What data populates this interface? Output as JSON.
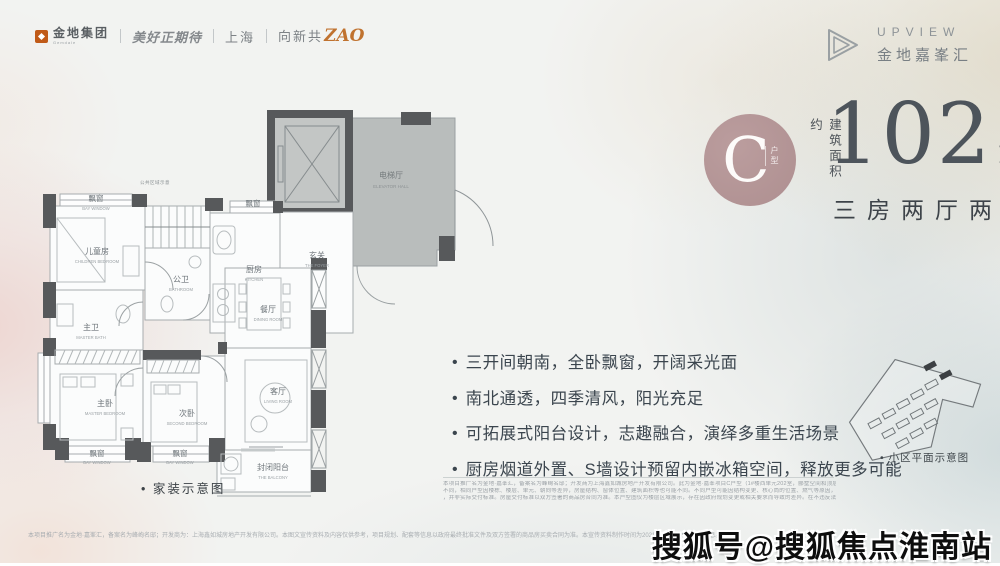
{
  "colors": {
    "accent_orange": "#c0722f",
    "badge_rose": "#b39596",
    "wall_dark": "#57595b",
    "hall_fill": "#b9bdbc",
    "headline_gray": "#4d545b"
  },
  "brandbar": {
    "gemdale_cn": "金地集团",
    "gemdale_en": "Gemdale",
    "slogan": "美好正期待",
    "city": "上海",
    "zao_prefix": "向新共",
    "zao": "ZAO"
  },
  "brand_right": {
    "name_en": "UPVIEW",
    "name_cn": "金地嘉峯汇"
  },
  "unit": {
    "type_letter": "C",
    "type_label": "户型",
    "area_prefix": "建筑面积约",
    "area_value": "102",
    "area_unit": "m",
    "area_sup": "2",
    "layout": "三房两厅两卫"
  },
  "features": [
    "三开间朝南，全卧飘窗，开阔采光面",
    "南北通透，四季清风，阳光充足",
    "可拓展式阳台设计，志趣融合，演绎多重生活场景",
    "厨房烟道外置、S墙设计预留内嵌冰箱空间，释放更多可能"
  ],
  "floorplan": {
    "caption": "• 家装示意图",
    "annotation": "公共区域示意",
    "rooms": {
      "bay": {
        "cn": "飘窗",
        "en": "BAY WINDOW"
      },
      "children": {
        "cn": "儿童房",
        "en": "CHILDREN BEDROOM"
      },
      "bath2": {
        "cn": "公卫",
        "en": "BATHROOM"
      },
      "kitchen": {
        "cn": "厨房",
        "en": "KITCHEN"
      },
      "foyer": {
        "cn": "玄关",
        "en": "THE FOYER"
      },
      "dining": {
        "cn": "餐厅",
        "en": "DINING ROOM"
      },
      "master_bath": {
        "cn": "主卫",
        "en": "MASTER BATH"
      },
      "master_bedroom": {
        "cn": "主卧",
        "en": "MASTER BEDROOM"
      },
      "second_bedroom": {
        "cn": "次卧",
        "en": "SECOND BEDROOM"
      },
      "living": {
        "cn": "客厅",
        "en": "LIVING ROOM"
      },
      "balcony": {
        "cn": "封闭阳台",
        "en": "THE BALCONY"
      },
      "elevator_hall": {
        "cn": "电梯厅",
        "en": "ELEVATOR HALL"
      }
    }
  },
  "siteplan": {
    "caption": "• 小区平面示意图"
  },
  "disclaimer_right": [
    "本项目推广名为金地·嘉峯汇，备案名为峰峋名邸；开发商为上海鑫如城房地产开发有限公司。此为金地·嘉峯项目C户型（1#楼西单元202室，郦墅空间和顶层1000弄56号202）户型示意图，建筑面积约102㎡",
    "不同，相同户型因楼栋、楼层、单元、朝向等差异，房屋结构、窗体位置、建筑面积等也可能不同。不同户型可能因结构变更、核心筒的位置、燃气等原因，选定面积与周边（如管道、设备平台、电梯厅尺寸）等不同",
    "，并非实际交付标准。房屋交付标准以双方签署的商品房合同为准。本户型图仅为楼层区域展示，存在因政府规划变更或相关要求而导致的差异。在不违反法律法规、合同约定的前提下，本公司有权对本模型"
  ],
  "disclaimer_bottom": "本项目推广名为金地·嘉峯汇，备案名为峰峋名邸；开发商为：上海鑫如城房地产开发有限公司。本图文宣传资料及内容仅供参考，项目规划、配套等信息以政府最终批准文件及双方签署的商品房买卖合同为准。本宣传资料制作时间为2021年，敬请关注最新信息。",
  "watermark": "搜狐号@搜狐焦点淮南站"
}
